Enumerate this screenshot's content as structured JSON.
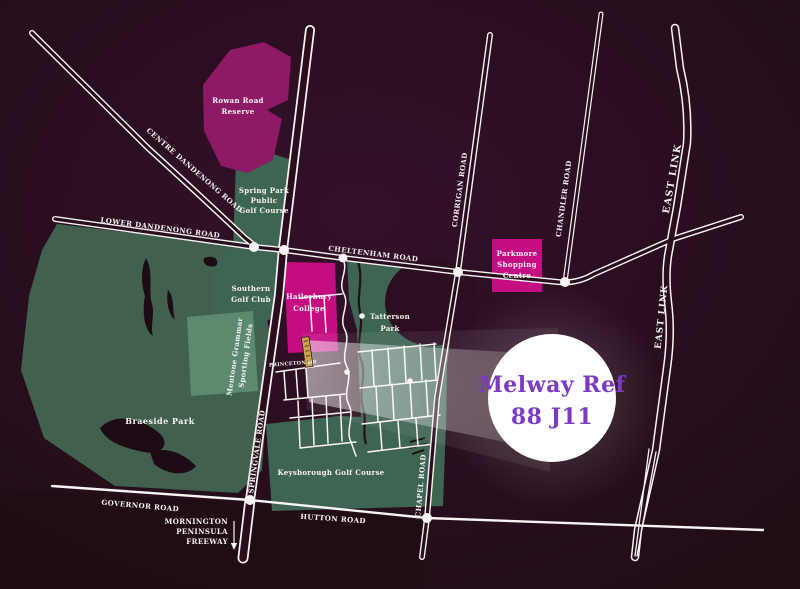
{
  "callout": {
    "line1": "Melway Ref",
    "line2": "88 J11"
  },
  "roads": {
    "centre_dandenong": "CENTRE DANDENONG ROAD",
    "lower_dandenong": "LOWER DANDENONG ROAD",
    "cheltenham": "CHELTENHAM ROAD",
    "corrigan": "CORRIGAN ROAD",
    "chandler": "CHANDLER ROAD",
    "east_link": "EAST LINK",
    "springvale": "SPRINGVALE ROAD",
    "chapel": "CHAPEL ROAD",
    "governor": "GOVERNOR ROAD",
    "hutton": "HUTTON ROAD",
    "princeton": "PRINCETON DR",
    "mornington": {
      "line1": "MORNINGTON",
      "line2": "PENINSULA",
      "line3": "FREEWAY"
    }
  },
  "places": {
    "rowan_road_reserve": {
      "line1": "Rowan Road",
      "line2": "Reserve"
    },
    "spring_park": {
      "line1": "Spring Park",
      "line2": "Public",
      "line3": "Golf Course"
    },
    "southern_golf": {
      "line1": "Southern",
      "line2": "Golf Club"
    },
    "haileybury": {
      "line1": "Haileybury",
      "line2": "College"
    },
    "mentone": {
      "line1": "Mentone Grammar",
      "line2": "Sporting Fields"
    },
    "tatterson": {
      "line1": "Tatterson",
      "line2": "Park"
    },
    "braeside": "Braeside Park",
    "keysborough": "Keysborough Golf Course",
    "parkmore": {
      "line1": "Parkmore",
      "line2": "Shopping",
      "line3": "Centre"
    }
  },
  "colors": {
    "background": "#2b0e20",
    "road_fill": "#2a0e1f",
    "road_white": "#f8f4f3",
    "park_green": "#3e6453",
    "braeside_green": "#41604e",
    "sports_field_green": "#5b8a6f",
    "reserve_magenta": "#8e1a66",
    "landmark_magenta": "#c30d80",
    "callout_purple": "#7b3abf",
    "site_marker_gold": "#c9a44a"
  }
}
